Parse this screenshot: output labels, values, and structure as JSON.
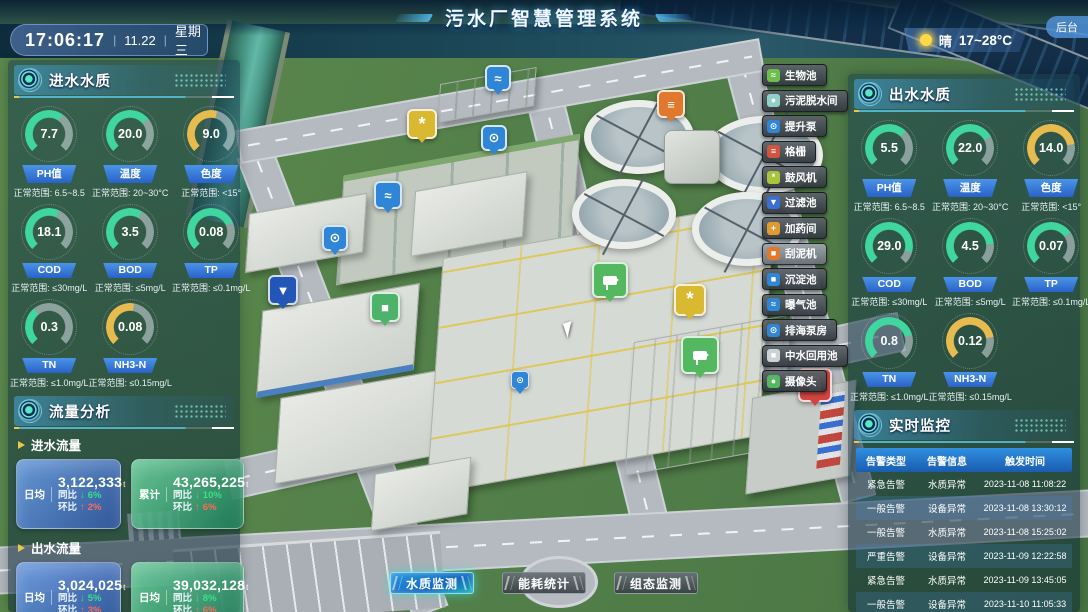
{
  "theme": {
    "green": "#3fd6a0",
    "yellow": "#e8bb4e",
    "accent_blue": "#2f7fd6",
    "alarm_header_blue": "#1f7fd0",
    "card_blue": "#3a63b8",
    "card_green": "#2a9a6c"
  },
  "glyphs": {
    "down_arrow": "↓",
    "up_arrow": "↑"
  },
  "header": {
    "title": "污水厂智慧管理系统",
    "backend_label": "后台"
  },
  "status_bar": {
    "time": "17:06:17",
    "date": "11.22",
    "weekday": "星期三",
    "weather_condition": "晴",
    "temp_range": "17~28°C"
  },
  "inlet_quality": {
    "title": "进水水质",
    "gauges": [
      {
        "value": "7.7",
        "label": "PH值",
        "range": "正常范围: 6.5~8.5",
        "tone": "green",
        "deg": 170
      },
      {
        "value": "20.0",
        "label": "温度",
        "range": "正常范围: 20~30°C",
        "tone": "green",
        "deg": 185
      },
      {
        "value": "9.0",
        "label": "色度",
        "range": "正常范围: <15°",
        "tone": "yellow",
        "deg": 150
      },
      {
        "value": "18.1",
        "label": "COD",
        "range": "正常范围: ≤30mg/L",
        "tone": "green",
        "deg": 160
      },
      {
        "value": "3.5",
        "label": "BOD",
        "range": "正常范围: ≤5mg/L",
        "tone": "green",
        "deg": 165
      },
      {
        "value": "0.08",
        "label": "TP",
        "range": "正常范围: ≤0.1mg/L",
        "tone": "green",
        "deg": 200
      },
      {
        "value": "0.3",
        "label": "TN",
        "range": "正常范围: ≤1.0mg/L",
        "tone": "green",
        "deg": 95
      },
      {
        "value": "0.08",
        "label": "NH3-N",
        "range": "正常范围: ≤0.15mg/L",
        "tone": "yellow",
        "deg": 145
      }
    ]
  },
  "flow_analysis": {
    "title": "流量分析",
    "inlet": {
      "label": "进水流量",
      "cards": [
        {
          "metric": "日均",
          "value": "3,122,333",
          "unit": "t",
          "yoy_label": "同比",
          "yoy_value": "6%",
          "mom_label": "环比",
          "mom_value": "2%"
        },
        {
          "metric": "累计",
          "value": "43,265,225",
          "unit": "t",
          "yoy_label": "同比",
          "yoy_value": "10%",
          "mom_label": "环比",
          "mom_value": "6%"
        }
      ]
    },
    "outlet": {
      "label": "出水流量",
      "cards": [
        {
          "metric": "日均",
          "value": "3,024,025",
          "unit": "t",
          "yoy_label": "同比",
          "yoy_value": "5%",
          "mom_label": "环比",
          "mom_value": "3%"
        },
        {
          "metric": "日均",
          "value": "39,032,128",
          "unit": "t",
          "yoy_label": "同比",
          "yoy_value": "8%",
          "mom_label": "环比",
          "mom_value": "6%"
        }
      ]
    }
  },
  "outlet_quality": {
    "title": "出水水质",
    "gauges": [
      {
        "value": "5.5",
        "label": "PH值",
        "range": "正常范围: 6.5~8.5",
        "tone": "green",
        "deg": 180
      },
      {
        "value": "22.0",
        "label": "温度",
        "range": "正常范围: 20~30°C",
        "tone": "green",
        "deg": 195
      },
      {
        "value": "14.0",
        "label": "色度",
        "range": "正常范围: <15°",
        "tone": "yellow",
        "deg": 215
      },
      {
        "value": "29.0",
        "label": "COD",
        "range": "正常范围: ≤30mg/L",
        "tone": "green",
        "deg": 240
      },
      {
        "value": "4.5",
        "label": "BOD",
        "range": "正常范围: ≤5mg/L",
        "tone": "green",
        "deg": 220
      },
      {
        "value": "0.07",
        "label": "TP",
        "range": "正常范围: ≤0.1mg/L",
        "tone": "green",
        "deg": 190
      },
      {
        "value": "0.8",
        "label": "TN",
        "range": "正常范围: ≤1.0mg/L",
        "tone": "green",
        "deg": 210
      },
      {
        "value": "0.12",
        "label": "NH3-N",
        "range": "正常范围: ≤0.15mg/L",
        "tone": "yellow",
        "deg": 215
      }
    ]
  },
  "monitoring": {
    "title": "实时监控",
    "columns": [
      "告警类型",
      "告警信息",
      "触发时间"
    ],
    "rows": [
      [
        "紧急告警",
        "水质异常",
        "2023-11-08 11:08:22"
      ],
      [
        "一般告警",
        "设备异常",
        "2023-11-08 13:30:12"
      ],
      [
        "一般告警",
        "水质异常",
        "2023-11-08 15:25:02"
      ],
      [
        "严重告警",
        "设备异常",
        "2023-11-09 12:22:58"
      ],
      [
        "紧急告警",
        "水质异常",
        "2023-11-09 13:45:05"
      ],
      [
        "一般告警",
        "设备异常",
        "2023-11-10 11:05:33"
      ],
      [
        "一般告警",
        "设备异常",
        "2023-11-10 15:02:44"
      ]
    ]
  },
  "facility_menu": {
    "items": [
      {
        "label": "生物池",
        "glyph": "≈",
        "color": "#6cc04a",
        "selected": false
      },
      {
        "label": "污泥脱水间",
        "glyph": "●",
        "color": "#8fd0c8",
        "selected": false
      },
      {
        "label": "提升泵",
        "glyph": "⊙",
        "color": "#2f86d6",
        "selected": false
      },
      {
        "label": "格栅",
        "glyph": "≡",
        "color": "#d05540",
        "selected": false
      },
      {
        "label": "鼓风机",
        "glyph": "*",
        "color": "#a8c43a",
        "selected": false
      },
      {
        "label": "过滤池",
        "glyph": "▼",
        "color": "#3a6fd0",
        "selected": false
      },
      {
        "label": "加药间",
        "glyph": "+",
        "color": "#e09a30",
        "selected": false
      },
      {
        "label": "刮泥机",
        "glyph": "■",
        "color": "#e0782e",
        "selected": true
      },
      {
        "label": "沉淀池",
        "glyph": "■",
        "color": "#2f86d6",
        "selected": false
      },
      {
        "label": "曝气池",
        "glyph": "≈",
        "color": "#2f86d6",
        "selected": false
      },
      {
        "label": "排海泵房",
        "glyph": "⊙",
        "color": "#2f86d6",
        "selected": false
      },
      {
        "label": "中水回用池",
        "glyph": "■",
        "color": "#c8d4d4",
        "selected": false
      },
      {
        "label": "摄像头",
        "glyph": "●",
        "color": "#53b85f",
        "selected": false
      }
    ]
  },
  "map_markers": [
    {
      "name": "aeration-basin",
      "glyph": "≈",
      "color": "#2f86d6"
    },
    {
      "name": "scraper",
      "glyph": "≡",
      "color": "#e0782e"
    },
    {
      "name": "blower-fan",
      "glyph": "*",
      "color": "#d9b832"
    },
    {
      "name": "lift-pump",
      "glyph": "⊙",
      "color": "#2f86d6"
    },
    {
      "name": "sedimentation",
      "glyph": "≈",
      "color": "#2f86d6"
    },
    {
      "name": "pump",
      "glyph": "⊙",
      "color": "#2f86d6"
    },
    {
      "name": "filter",
      "glyph": "▼",
      "color": "#2456b8"
    },
    {
      "name": "reuse-pool",
      "glyph": "■",
      "color": "#4db36a"
    },
    {
      "name": "camera",
      "glyph": "",
      "color": "#53b85f"
    },
    {
      "name": "blower-fan",
      "glyph": "*",
      "color": "#d9b832"
    },
    {
      "name": "camera",
      "glyph": "",
      "color": "#53b85f"
    },
    {
      "name": "lock",
      "glyph": "",
      "color": "#d04540"
    },
    {
      "name": "pump-small",
      "glyph": "⊙",
      "color": "#2f86d6"
    }
  ],
  "bottom_tabs": [
    {
      "label": "水质监测",
      "active": true
    },
    {
      "label": "能耗统计",
      "active": false
    },
    {
      "label": "组态监测",
      "active": false
    }
  ]
}
